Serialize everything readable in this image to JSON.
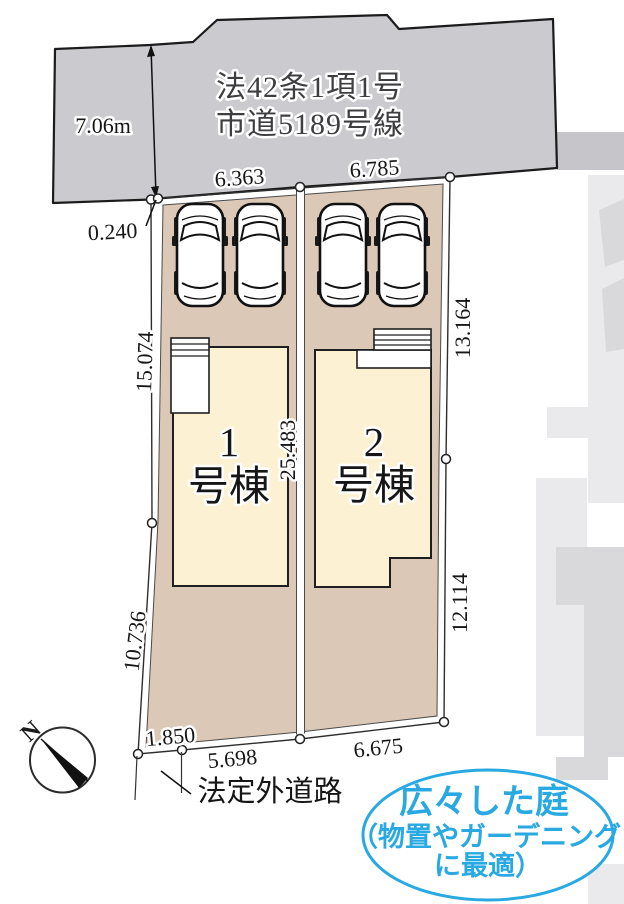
{
  "plan": {
    "road": {
      "name_line1": "法42条1項1号",
      "name_line2": "市道5189号線",
      "width": "7.06m"
    },
    "dimensions": {
      "frontage_left": "6.363",
      "frontage_right": "6.785",
      "corner_offset": "0.240",
      "left_upper": "15.074",
      "left_lower": "10.736",
      "center": "25.483",
      "right_upper": "13.164",
      "right_lower": "12.114",
      "bottom_small": "1.850",
      "bottom_left": "5.698",
      "bottom_right": "6.675"
    },
    "buildings": {
      "b1": {
        "number": "1",
        "label": "号棟"
      },
      "b2": {
        "number": "2",
        "label": "号棟"
      }
    },
    "bottom_road_label": "法定外道路",
    "compass": {
      "label": "N"
    },
    "callout": {
      "line1": "広々した庭",
      "line2": "（物置やガーデニング",
      "line3": "に最適）"
    },
    "colors": {
      "road_fill": "#cbcbcf",
      "lot_fill": "#dcc8b7",
      "building_fill": "#fcf2d3",
      "callout_blue": "#29a9e1",
      "watermark_light": "#eaeaed",
      "watermark_mid": "#d9d9dc"
    }
  }
}
